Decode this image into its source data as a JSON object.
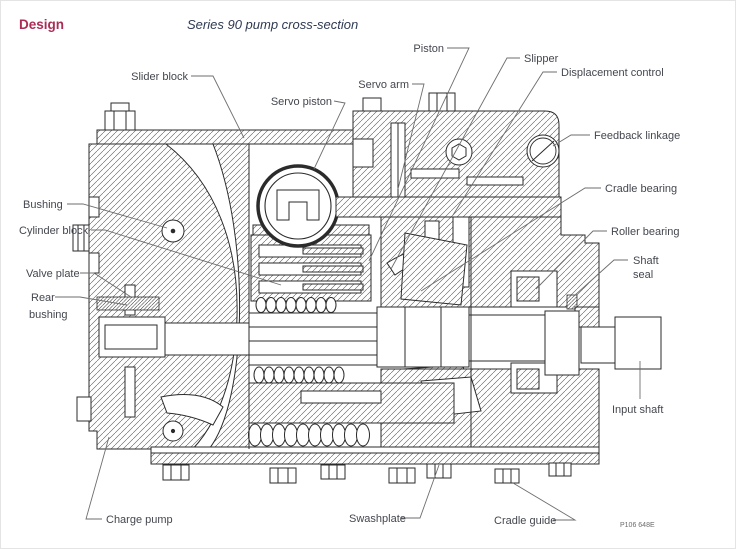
{
  "header": {
    "section_label": "Design",
    "title": "Series 90 pump cross-section"
  },
  "figure": {
    "number": "P106 648E",
    "description": "cross-section line drawing of Series 90 axial piston pump"
  },
  "labels": {
    "slider_block": {
      "text": "Slider block"
    },
    "servo_piston": {
      "text": "Servo piston"
    },
    "servo_arm": {
      "text": "Servo arm"
    },
    "piston": {
      "text": "Piston"
    },
    "slipper": {
      "text": "Slipper"
    },
    "displacement_control": {
      "text": "Displacement control"
    },
    "feedback_linkage": {
      "text": "Feedback linkage"
    },
    "cradle_bearing": {
      "text": "Cradle bearing"
    },
    "roller_bearing": {
      "text": "Roller bearing"
    },
    "shaft_seal": {
      "lines": [
        "Shaft",
        "seal"
      ]
    },
    "input_shaft": {
      "text": "Input shaft"
    },
    "bushing": {
      "text": "Bushing"
    },
    "cylinder_block": {
      "text": "Cylinder block"
    },
    "valve_plate": {
      "text": "Valve plate"
    },
    "rear_bushing": {
      "lines": [
        "Rear",
        "bushing"
      ]
    },
    "charge_pump": {
      "text": "Charge pump"
    },
    "swashplate": {
      "text": "Swashplate"
    },
    "cradle_guide": {
      "text": "Cradle guide"
    }
  },
  "colors": {
    "accent": "#ab2d56",
    "title": "#2f3a52",
    "label": "#44474f",
    "drawing_line": "#2b2b2b",
    "leader_line": "#6e6e6e",
    "background": "#ffffff"
  }
}
